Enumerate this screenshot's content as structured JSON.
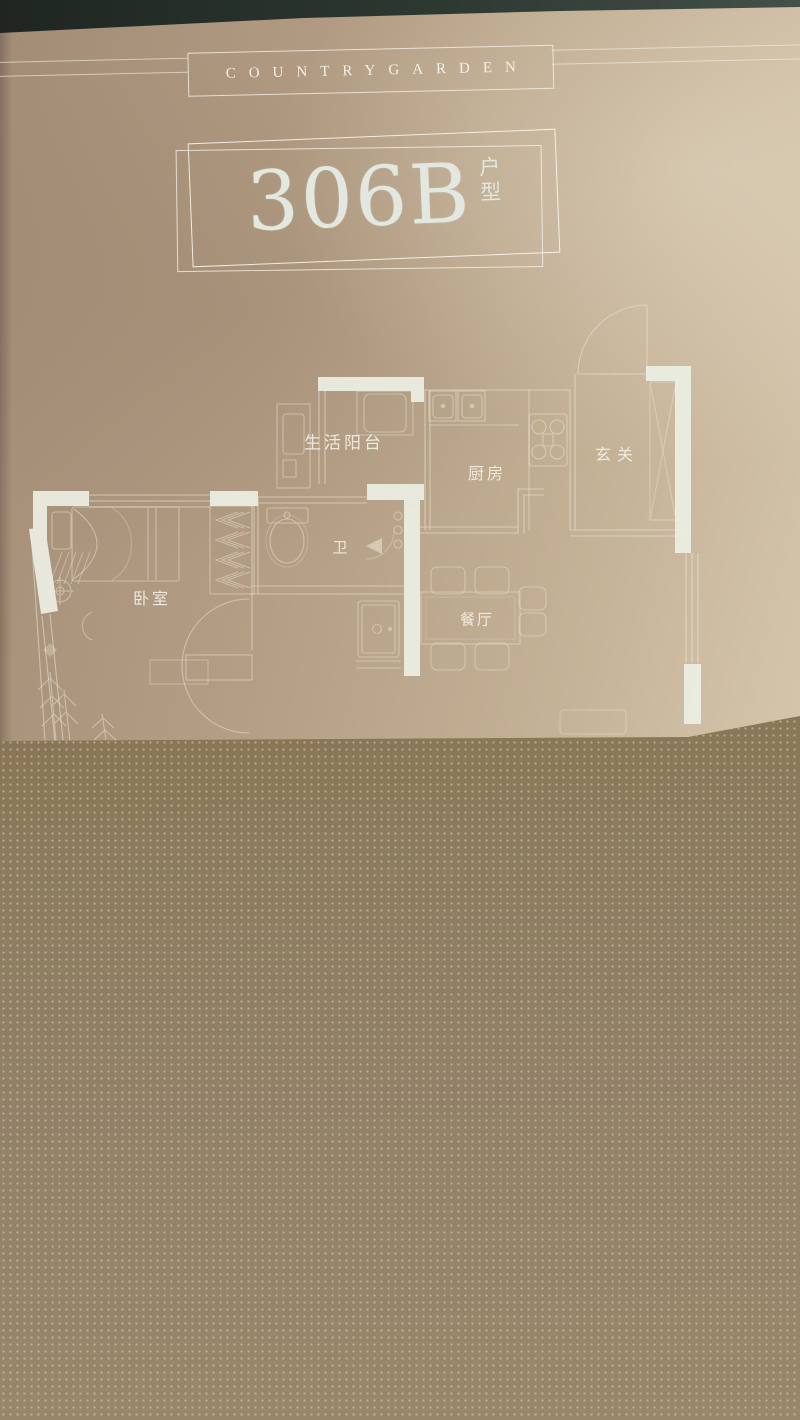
{
  "photo": {
    "brand": "COUNTRYGARDEN",
    "title": {
      "number": "306B",
      "suffix_top": "户",
      "suffix_bottom": "型"
    },
    "floorplan": {
      "rooms": [
        {
          "id": "balcony",
          "label": "生活阳台"
        },
        {
          "id": "kitchen",
          "label": "厨房"
        },
        {
          "id": "entry",
          "label": "玄关"
        },
        {
          "id": "bath",
          "label": "卫"
        },
        {
          "id": "bedroom",
          "label": "卧室"
        },
        {
          "id": "dining",
          "label": "餐厅"
        }
      ]
    },
    "colors": {
      "paper_tan": "#b8a388",
      "paper_highlight": "#d8cbb2",
      "line_white": "#f2eede",
      "wall_fill": "#ecefe3",
      "top_strip": "#2d3831",
      "dark_region": "#8f7e63",
      "title_text": "#e2e7df"
    }
  }
}
